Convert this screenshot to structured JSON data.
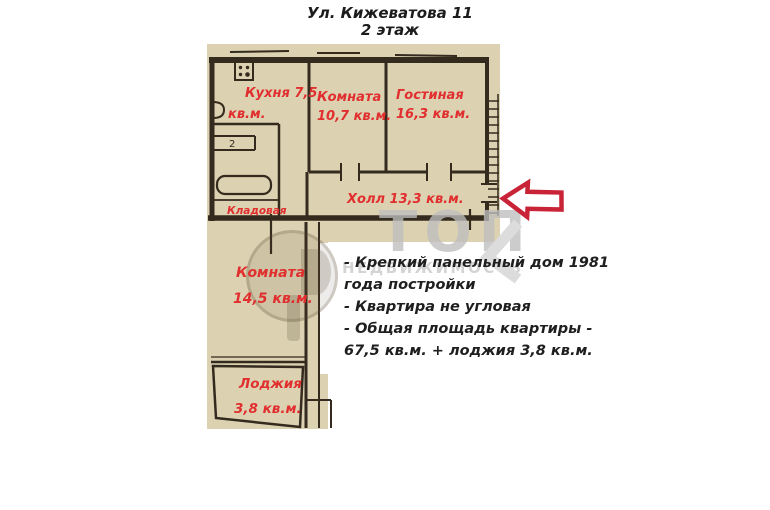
{
  "title": {
    "line1": "Ул. Кижеватова 11",
    "line2": "2 этаж"
  },
  "plan": {
    "colors": {
      "paper": "#dcd2b2",
      "wall": "#342a1d",
      "label": "#e12e2e"
    },
    "labels": {
      "kitchen": {
        "line1": "Кухня 7,5",
        "line2": "кв.м."
      },
      "small_room": {
        "line1": "Комната",
        "line2": "10,7 кв.м."
      },
      "living_room": {
        "line1": "Гостиная",
        "line2": "16,3 кв.м."
      },
      "hall": {
        "line1": "Холл 13,3 кв.м."
      },
      "storage": {
        "line1": "Кладовая"
      },
      "big_room": {
        "line1": "Комната",
        "line2": "14,5 кв.м."
      },
      "loggia": {
        "line1": "Лоджия",
        "line2": "3,8 кв.м."
      },
      "toilet": "2"
    }
  },
  "description": {
    "lines": [
      "- Крепкий панельный дом 1981",
      "года постройки",
      "- Квартира не угловая",
      "- Общая площадь квартиры -",
      "67,5 кв.м. + лоджия 3,8 кв.м."
    ]
  },
  "watermark": {
    "brand": "ТОП",
    "sub": "НЕДВИЖИМОСТЬ"
  },
  "arrow": {
    "color": "#c92337",
    "direction": "left"
  }
}
